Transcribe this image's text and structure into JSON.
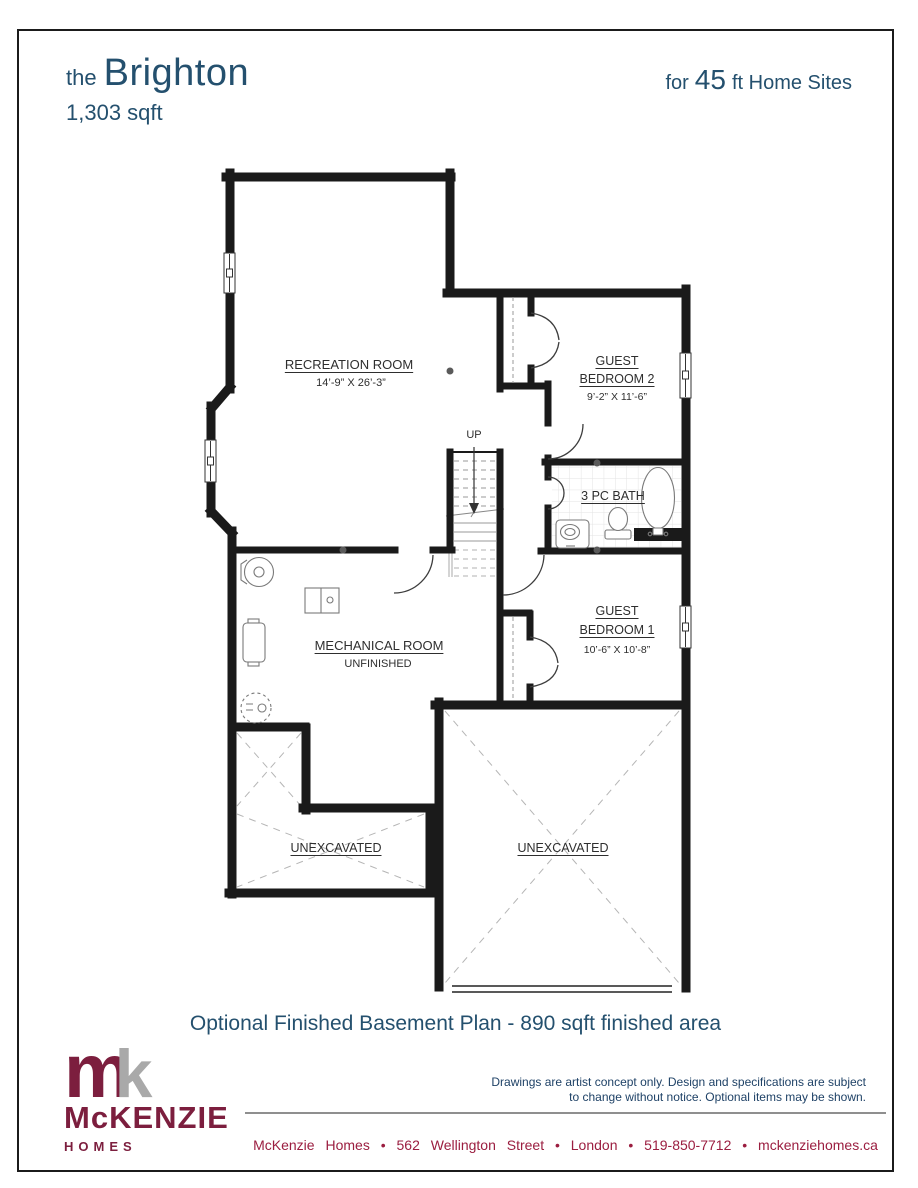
{
  "header": {
    "the": "the",
    "title": "Brighton",
    "sqft": "1,303 sqft",
    "for": "for",
    "size": "45",
    "suffix": "ft Home Sites"
  },
  "plan": {
    "recreation": {
      "name": "RECREATION ROOM",
      "dims": "14’-9” X 26’-3”"
    },
    "bedroom2": {
      "line1": "GUEST",
      "line2": "BEDROOM 2",
      "dims": "9’-2” X 11’-6”"
    },
    "bath": {
      "name": "3 PC BATH"
    },
    "bedroom1": {
      "line1": "GUEST",
      "line2": "BEDROOM 1",
      "dims": "10’-6” X 10’-8”"
    },
    "mechanical": {
      "name": "MECHANICAL ROOM",
      "sub": "UNFINISHED"
    },
    "stairs": {
      "label": "UP"
    },
    "unexcavated_left": "UNEXCAVATED",
    "unexcavated_right": "UNEXCAVATED"
  },
  "caption": "Optional Finished Basement Plan - 890 sqft finished area",
  "footer": {
    "logo": {
      "m": "m",
      "k": "k",
      "name": "McKENZIE",
      "homes": "HOMES"
    },
    "disclaimer1": "Drawings are artist concept only. Design and specifications are subject",
    "disclaimer2": "to change without notice. Optional items may be shown.",
    "contact": "McKenzie Homes  •  562 Wellington Street  •  London •  519-850-7712  •  mckenziehomes.ca"
  },
  "colors": {
    "heading_blue": "#24506e",
    "brand_maroon": "#7c1e3e",
    "logo_gray": "#a9a9a9",
    "contact_maroon": "#9b1e40",
    "wall_black": "#1a1a1a"
  }
}
